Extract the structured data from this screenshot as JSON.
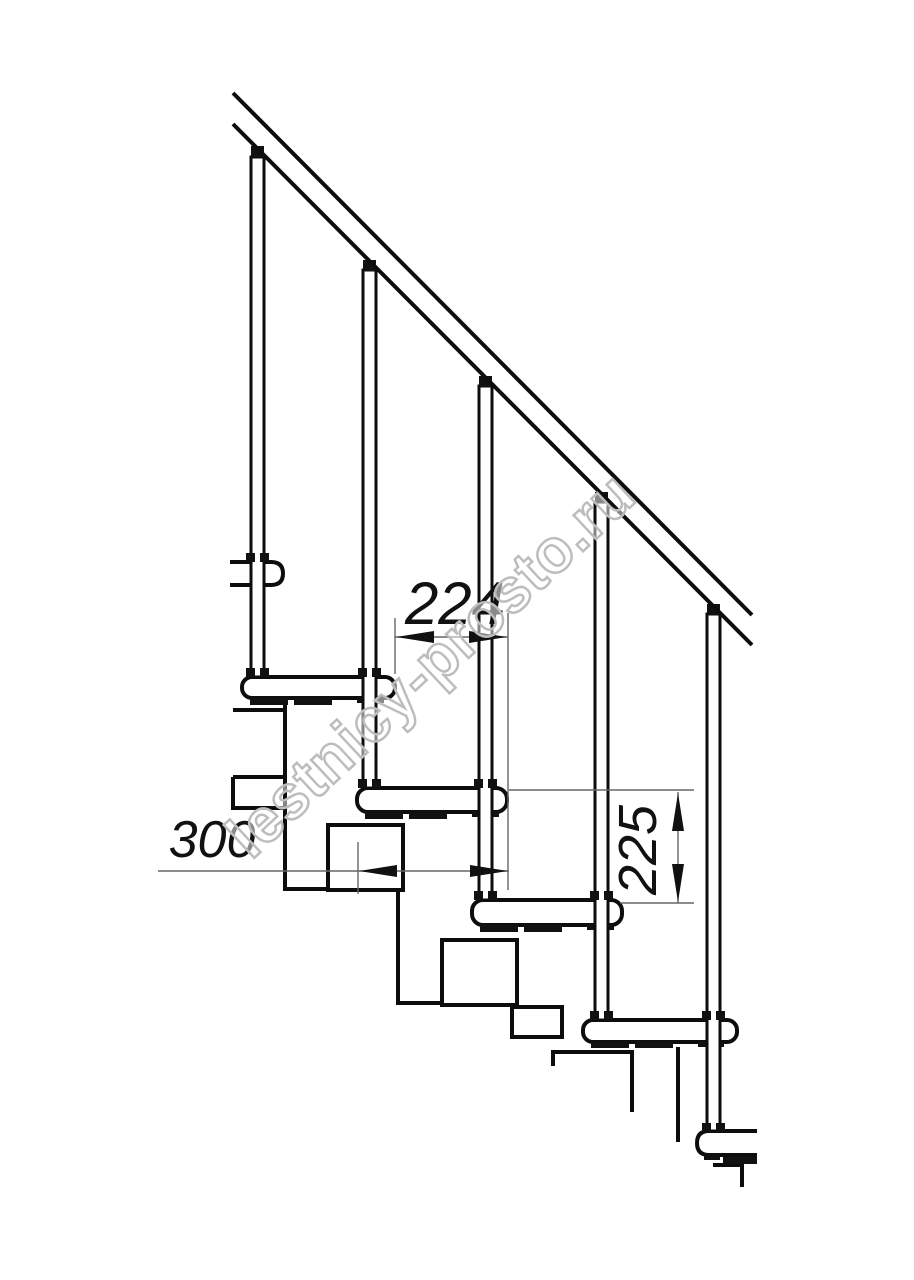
{
  "drawing": {
    "background": "#ffffff",
    "line_color": "#0d0d0d",
    "dimension_color": "#666666",
    "dimensions": {
      "step_run": {
        "label": "224"
      },
      "tread_depth": {
        "label": "300"
      },
      "step_rise": {
        "label": "225"
      }
    },
    "watermark": {
      "text": "lestnicy-prosto.ru",
      "color": "#bdbdbd"
    }
  }
}
